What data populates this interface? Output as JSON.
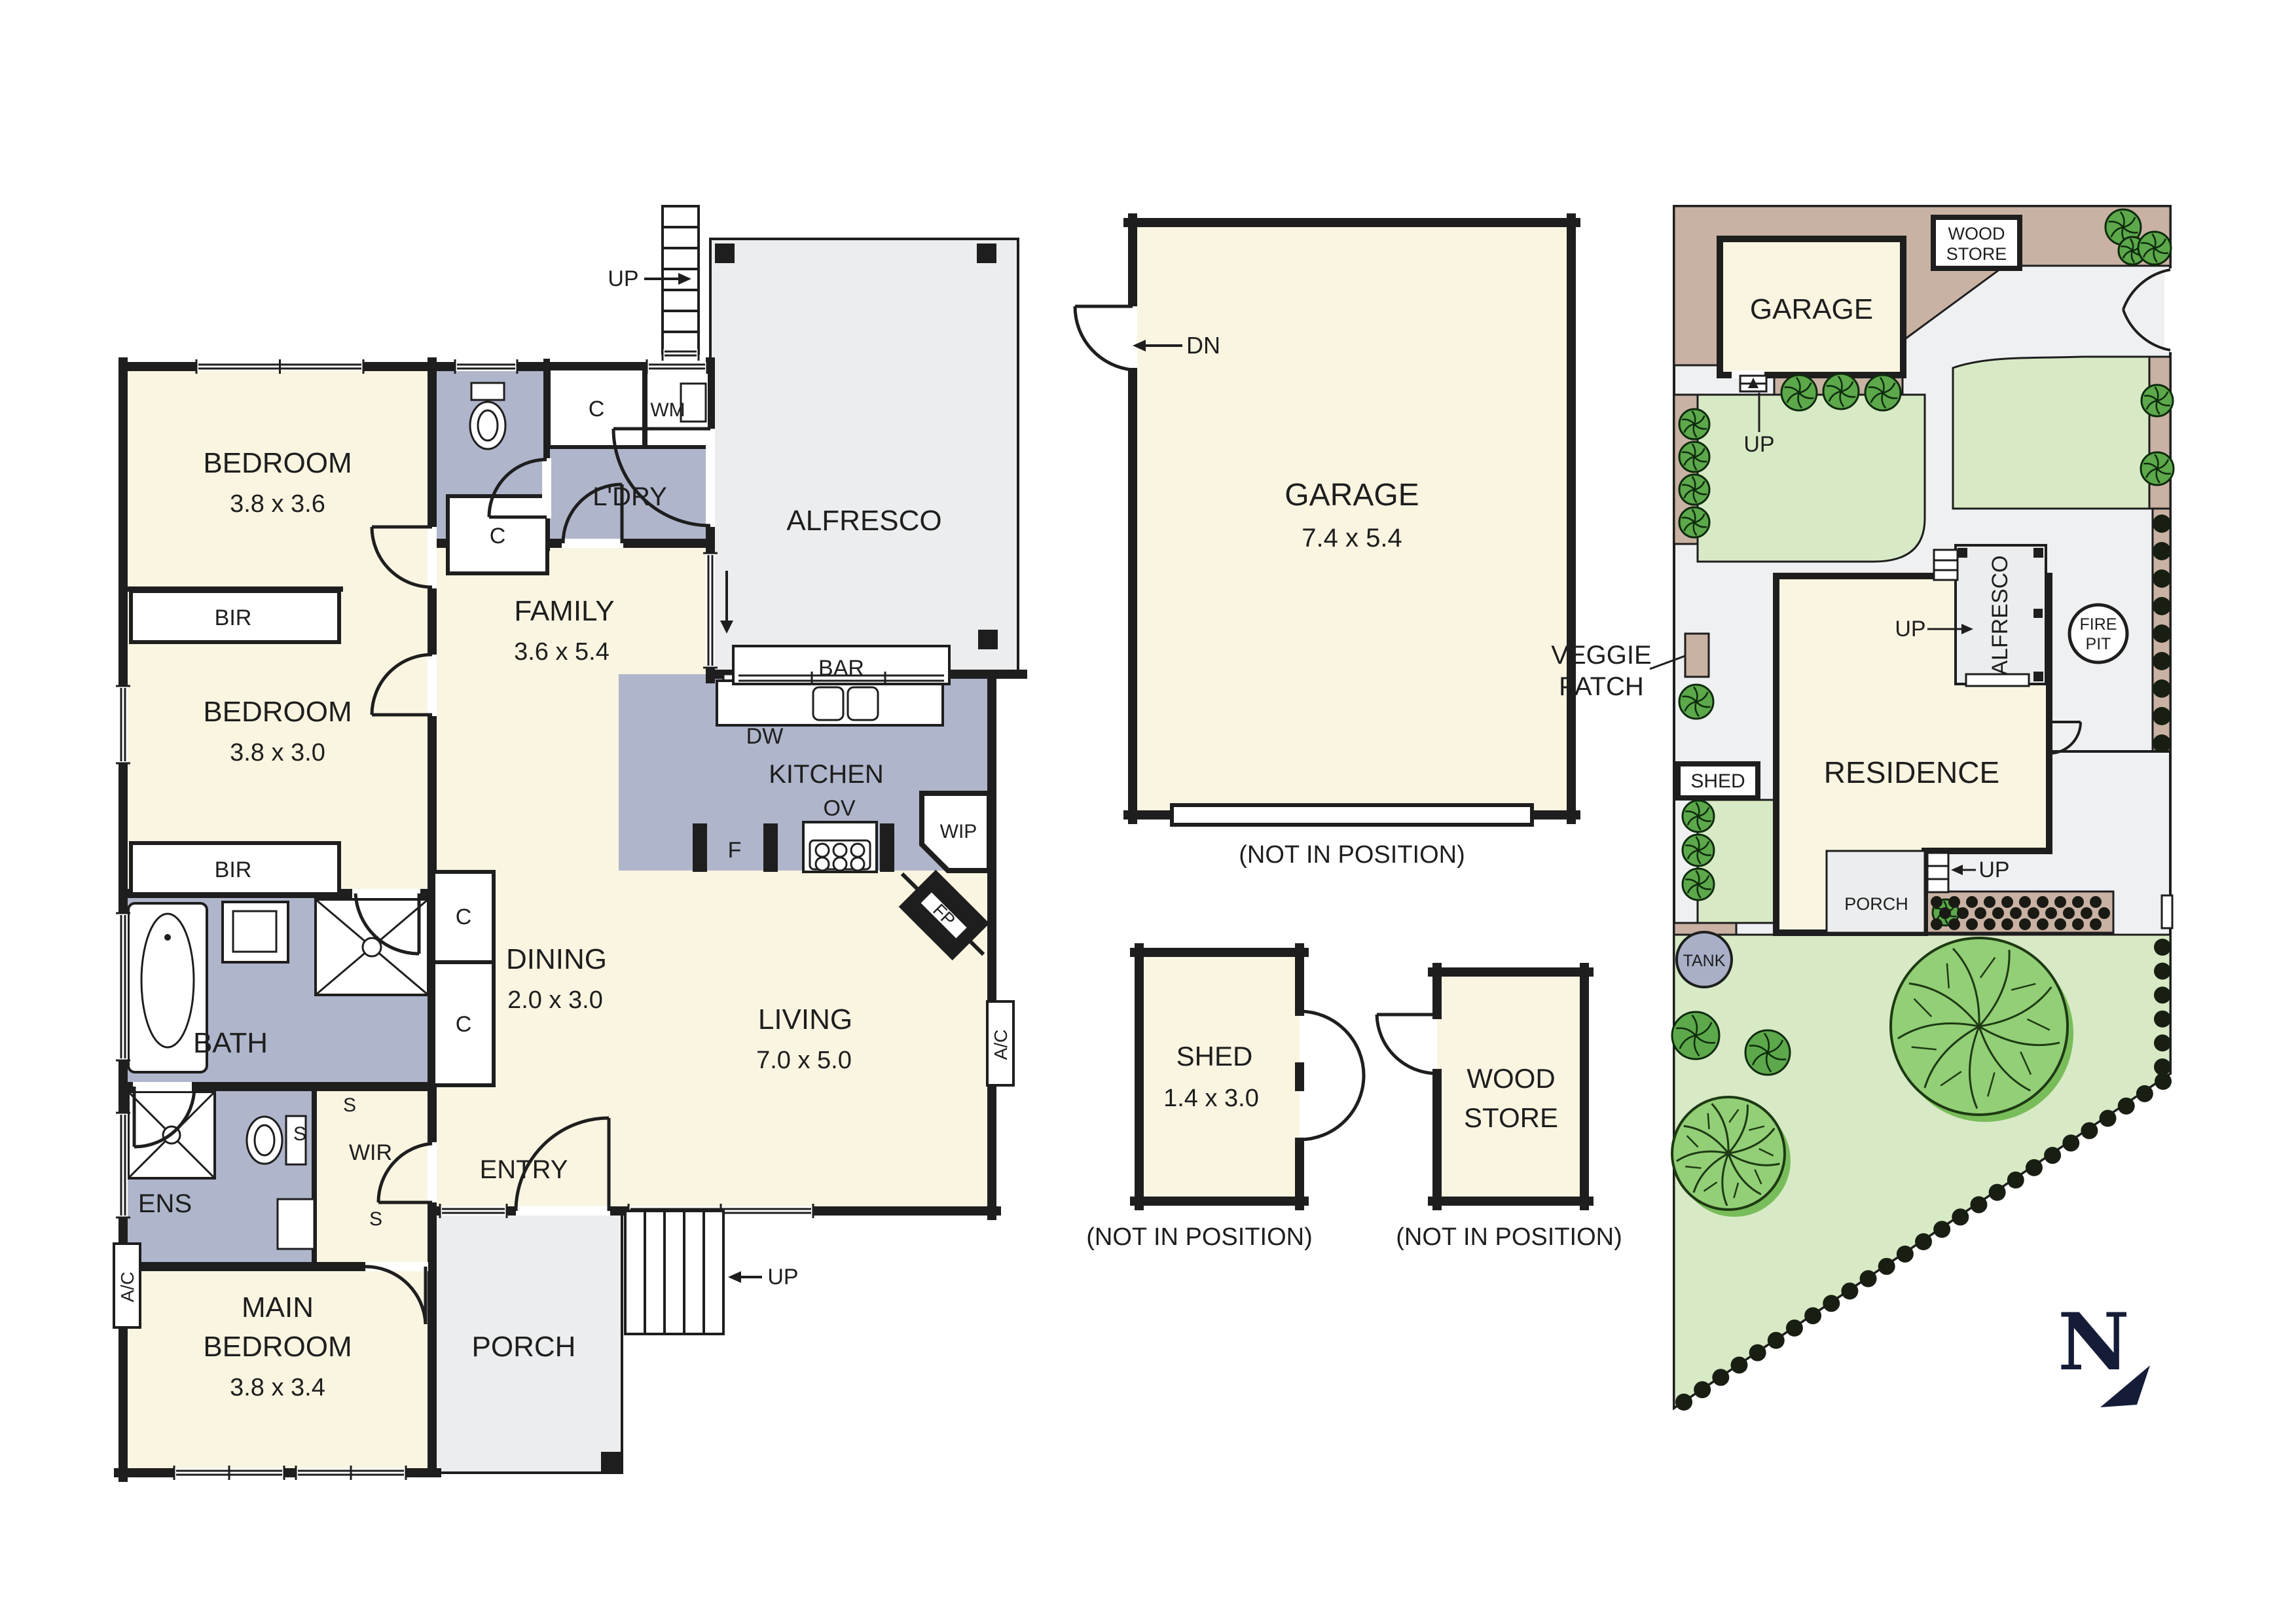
{
  "floorplan": {
    "bedroom1": {
      "name": "BEDROOM",
      "dims": "3.8 x 3.6"
    },
    "bedroom2": {
      "name": "BEDROOM",
      "dims": "3.8 x 3.0"
    },
    "main_bedroom": {
      "line1": "MAIN",
      "line2": "BEDROOM",
      "dims": "3.8 x 3.4"
    },
    "bir": "BIR",
    "bath": "BATH",
    "ens": "ENS",
    "wir": "WIR",
    "s": "S",
    "c": "C",
    "wm": "WM",
    "laundry": "L'DRY",
    "family": {
      "name": "FAMILY",
      "dims": "3.6 x 5.4"
    },
    "dining": {
      "name": "DINING",
      "dims": "2.0 x 3.0"
    },
    "living": {
      "name": "LIVING",
      "dims": "7.0 x 5.0"
    },
    "kitchen": {
      "name": "KITCHEN",
      "dw": "DW",
      "ov": "OV",
      "f": "F",
      "wip": "WIP",
      "bar": "BAR",
      "fp": "FP"
    },
    "entry": "ENTRY",
    "porch": "PORCH",
    "alfresco": "ALFRESCO",
    "ac": "A/C",
    "up": "UP"
  },
  "outbuildings": {
    "garage": {
      "name": "GARAGE",
      "dims": "7.4 x 5.4",
      "dn": "DN",
      "note": "(NOT IN POSITION)"
    },
    "shed": {
      "name": "SHED",
      "dims": "1.4 x 3.0",
      "note": "(NOT IN POSITION)"
    },
    "woodstore": {
      "line1": "WOOD",
      "line2": "STORE",
      "note": "(NOT IN POSITION)"
    }
  },
  "siteplan": {
    "garage": "GARAGE",
    "woodstore_line1": "WOOD",
    "woodstore_line2": "STORE",
    "residence": "RESIDENCE",
    "alfresco": "ALFRESCO",
    "firepit_line1": "FIRE",
    "firepit_line2": "PIT",
    "veggie_line1": "VEGGIE",
    "veggie_line2": "PATCH",
    "shed": "SHED",
    "tank": "TANK",
    "porch": "PORCH",
    "up": "UP"
  },
  "compass": {
    "north": "N"
  },
  "colors": {
    "room_fill": "#FAF5E1",
    "wet_area_fill": "#AFB5CB",
    "outdoor_grey": "#ECEDEE",
    "wall": "#1e1e1e",
    "lawn": "#D8EAC5",
    "garden_bed": "#C9B2A3",
    "tree_light": "#92CF77",
    "tree_dark": "#5CA84B",
    "compass_navy": "#151C38",
    "tank_fill": "#A9AFC6"
  },
  "icons": {
    "tree-icon": "circular shrub symbol",
    "hedge-dot-icon": "dark hedge shrub dot",
    "north-arrow-icon": "N with pointer triangle",
    "stair-icon": "stair treads",
    "door-arc-icon": "door swing arc"
  }
}
